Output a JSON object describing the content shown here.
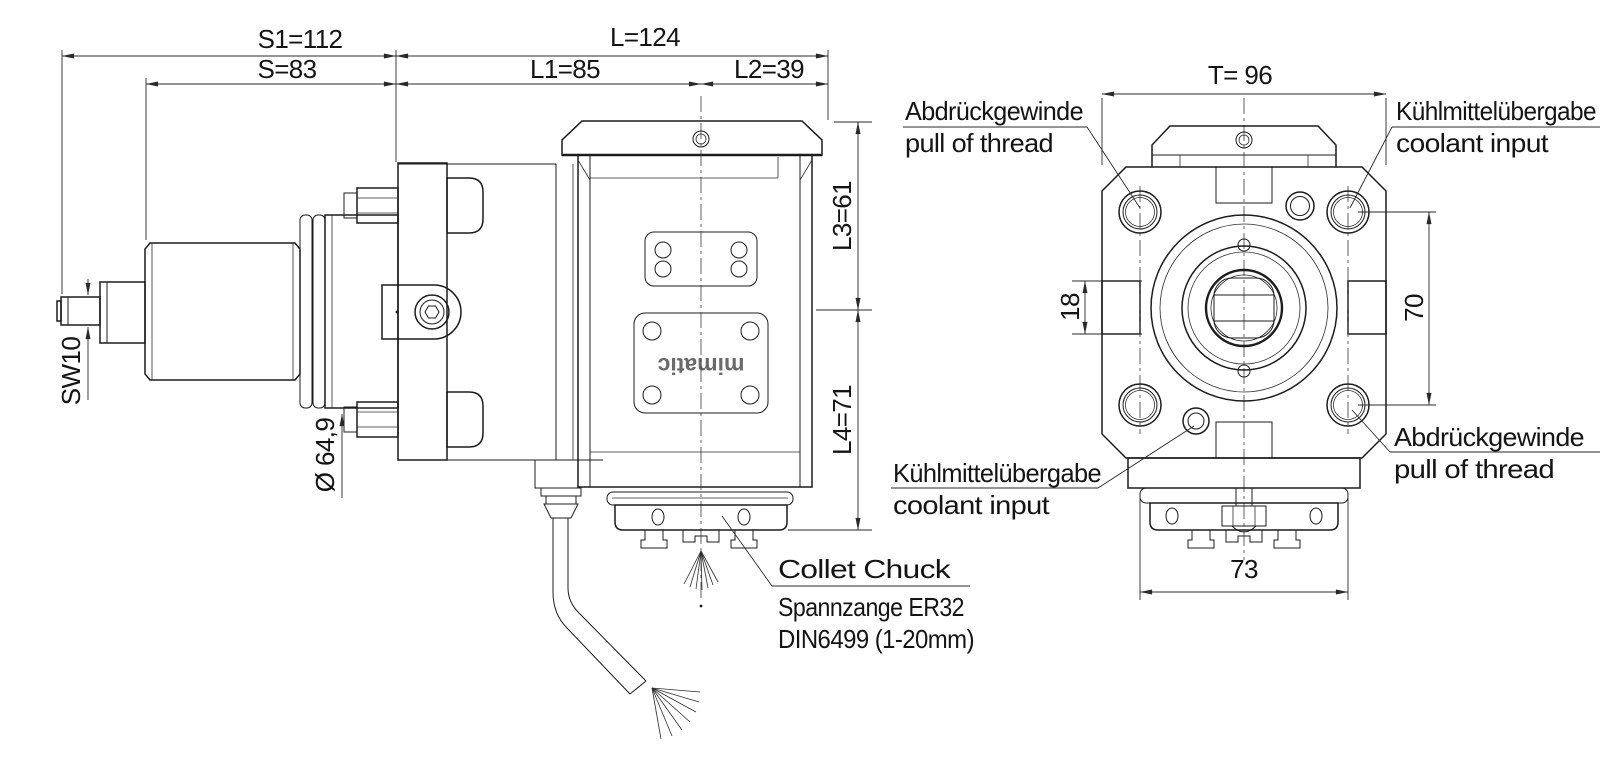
{
  "drawing": {
    "dimensions": {
      "s1": "S1=112",
      "s": "S=83",
      "l": "L=124",
      "l1": "L1=85",
      "l2": "L2=39",
      "l3": "L3=61",
      "l4": "L4=71",
      "sw": "SW10",
      "dia": "Ø 64,9",
      "t": "T= 96",
      "n18": "18",
      "n70": "70",
      "n73": "73"
    },
    "annotations": {
      "collet_chuck": "Collet Chuck",
      "spannzange": "Spannzange ER32",
      "din": "DIN6499 (1-20mm)",
      "abdrueckgewinde": "Abdrückgewinde",
      "pull_of_thread": "pull of thread",
      "kuehlmitteluebergabe": "Kühlmittelübergabe",
      "coolant_input": "coolant input"
    },
    "logo": "mimatic",
    "colors": {
      "line": "#1c1c1c",
      "background": "#ffffff"
    }
  }
}
